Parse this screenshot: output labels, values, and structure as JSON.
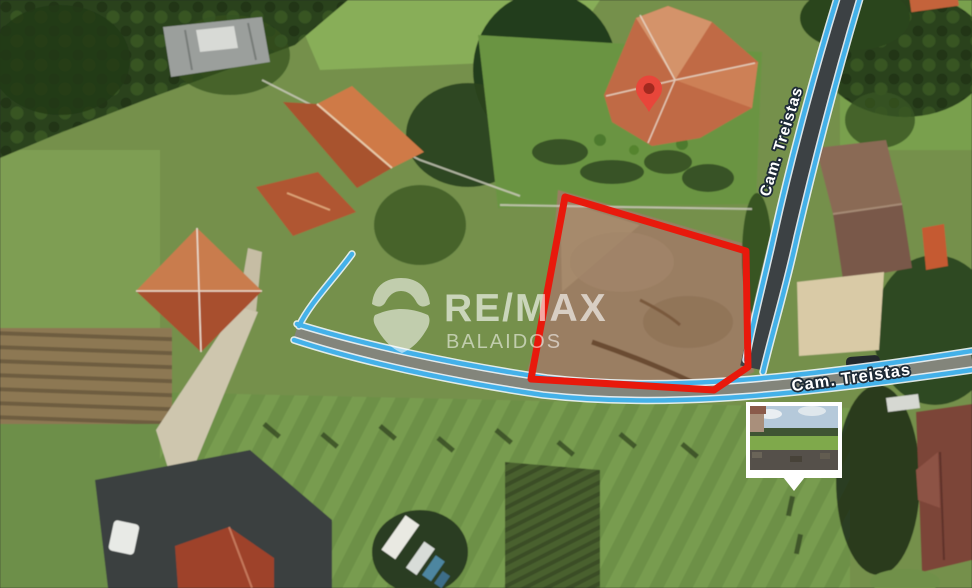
{
  "map": {
    "type": "satellite-aerial-view",
    "streets": {
      "vertical_label": "Cam. Treistas",
      "horizontal_label": "Cam. Treistas"
    },
    "watermark": {
      "brand": "RE/MAX",
      "office": "BALAIDOS"
    },
    "overlays": {
      "property_boundary": "red-outlined-parcel",
      "marker": "red-location-pin",
      "road_trace": "blue-route-lines",
      "thumbnail": "street-photo-inset"
    },
    "colors": {
      "boundary": "#e8190c",
      "road_trace": "#44b1e9",
      "pin": "#e8463a",
      "pin_core": "#a2291f",
      "label_text": "#ffffff",
      "label_outline": "#1d2a36"
    }
  }
}
